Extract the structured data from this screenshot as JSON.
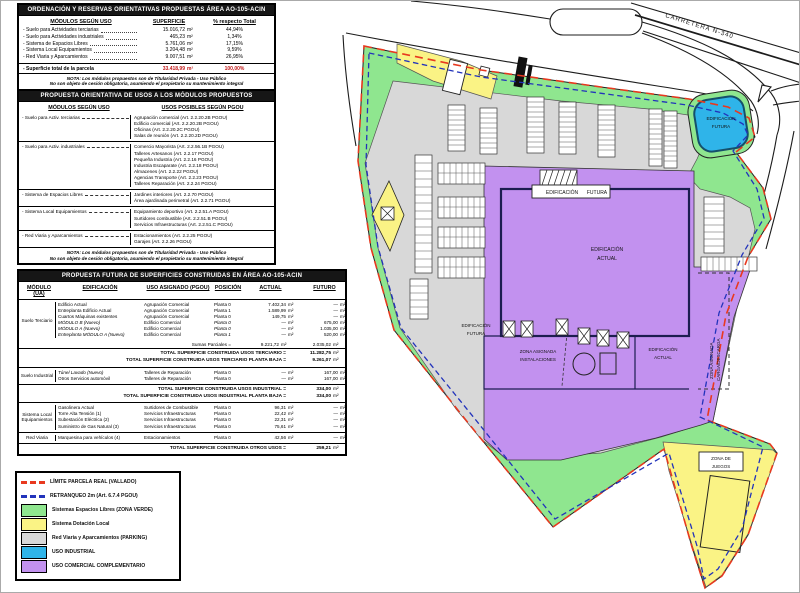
{
  "units": {
    "m2": "m²"
  },
  "table1": {
    "title": "ORDENACIÓN Y RESERVAS ORIENTATIVAS PROPUESTAS ÁREA AO-105-ACIN",
    "col_headers": {
      "modulos": "MÓDULOS SEGÚN USO",
      "superficie": "SUPERFICIE",
      "pct": "% respecto Total"
    },
    "rows": [
      {
        "label": "- Suelo para Actividades terciarias",
        "value": "15.016,72",
        "pct": "44,94%"
      },
      {
        "label": "- Suelo para Actividades industriales",
        "value": "465,23",
        "pct": "1,34%"
      },
      {
        "label": "- Sistema de Espacios Libres",
        "value": "5.761,06",
        "pct": "17,15%"
      },
      {
        "label": "- Sistema Local Equipamientos",
        "value": "3.204,48",
        "pct": "9,59%"
      },
      {
        "label": "- Red Viaria y Aparcamientos",
        "value": "9.007,51",
        "pct": "26,95%"
      }
    ],
    "total": {
      "label": "- Superficie total de la parcela",
      "value": "33.418,99",
      "pct": "100,00%"
    },
    "note1": "NOTA: Los módulos propuestos son de Titularidad Privada - Uso Público",
    "note2": "No son objeto de cesión obligatoria, asumiendo el propietario su mantenimiento integral"
  },
  "table2": {
    "title": "PROPUESTA ORIENTATIVA DE USOS A LOS MÓDULOS PROPUESTOS",
    "col_headers": {
      "modulos": "MÓDULOS SEGÚN USO",
      "usos": "USOS POSIBLES SEGÚN PGOU"
    },
    "rows": [
      {
        "label": "- Suelo para Activ. terciarias",
        "usos": [
          "Agrupación comercial (Art. 2.2.20.2B PGOU)",
          "Edificio comercial (Art. 2.2.20.2B PGOU)",
          "Oficinas (Art. 2.2.20.2C PGOU)",
          "Salas de reunión (Art. 2.2.20.2D PGOU)"
        ]
      },
      {
        "label": "- Suelo para Activ. industriales",
        "usos": [
          "Comercio Mayorista (Art. 2.2.56.1B PGOU)",
          "Talleres Artesanos (Art. 2.2.17 PGOU)",
          "Pequeña Industria (Art. 2.2.16 PGOU)",
          "Industria Escaparate (Art. 2.2.18 PGOU)",
          "Almacenes (Art. 2.2.22 PGOU)",
          "Agencias Transporte (Art. 2.2.23 PGOU)",
          "Talleres Reparación (Art. 2.2.24 PGOU)"
        ]
      },
      {
        "label": "- Sistema de Espacios Libres",
        "usos": [
          "Jardines interiores (Art. 2.2.70 PGOU)",
          "Área ajardinada perimetral (Art. 2.2.71 PGOU)"
        ]
      },
      {
        "label": "- Sistema Local Equipamientos",
        "usos": [
          "Equipamiento deportivo (Art. 2.2.51.A PGOU)",
          "Surtidores combustible (Art. 2.2.51.B PGOU)",
          "Servicios Infraestructuras (Art. 2.2.51.C PGOU)"
        ]
      },
      {
        "label": "- Red Viaria y Aparcamientos",
        "usos": [
          "Estacionamientos (Art. 2.2.25 PGOU)",
          "Garajes (Art. 2.2.26 PGOU)"
        ]
      }
    ],
    "note1": "NOTA: Los módulos propuestos son de Titularidad Privada - Uso Público",
    "note2": "No son objeto de cesión obligatoria, asumiendo el propietario su mantenimiento integral"
  },
  "table3": {
    "title": "PROPUESTA FUTURA DE SUPERFICIES CONSTRUIDAS EN ÁREA AO-105-ACIN",
    "headers": {
      "modulo": "MÓDULO (UA)",
      "edificacion": "EDIFICACIÓN",
      "uso": "USO ASIGNADO (PGOU)",
      "posicion": "POSICIÓN",
      "actual": "ACTUAL",
      "futuro": "FUTURO"
    },
    "terciario": {
      "module": "Suelo Terciario",
      "rows": [
        [
          "Edificio Actual",
          "Agrupación Comercial",
          "Planta 0",
          "7.402,34",
          "—"
        ],
        [
          "Entreplanta Edificio Actual",
          "Agrupación Comercial",
          "Planta 1",
          "1.589,99",
          "—"
        ],
        [
          "Cuartos Máquinas existentes",
          "Agrupación Comercial",
          "Planta 0",
          "149,75",
          "—"
        ],
        [
          "MÓDULO B (Nuevo)",
          "Edificio Comercial",
          "Planta 0",
          "—",
          "675,00"
        ],
        [
          "MÓDULO A (Nuevo)",
          "Edificio Comercial",
          "Planta 0",
          "—",
          "1.035,00"
        ],
        [
          "Entreplanta MÓDULO A (Nuevo)",
          "Edificio Comercial",
          "Planta 1",
          "—",
          "520,00"
        ]
      ],
      "sumas_label": "Sumas Parciales =",
      "sumas_actual": "9.221,72",
      "sumas_futuro": "2.035,02",
      "total1_label": "TOTAL SUPERFICIE CONSTRUIDA USOS TERCIARIO =",
      "total1_value": "11.282,75",
      "total2_label": "TOTAL SUPERFICIE CONSTRUIDA USOS TERCIARIO PLANTA BAJA =",
      "total2_value": "9.261,07"
    },
    "industrial": {
      "module": "Suelo Industrial",
      "rows": [
        [
          "Túnel Lavado (Nuevo)",
          "Talleres de Reparación",
          "Planta 0",
          "—",
          "167,00"
        ],
        [
          "Otros Servicios automóvil",
          "Talleres de Reparación",
          "Planta 0",
          "—",
          "167,00"
        ]
      ],
      "total1_label": "TOTAL SUPERFICIE CONSTRUIDA USOS INDUSTRIAL =",
      "total1_value": "334,00",
      "total2_label": "TOTAL SUPERFICIE CONSTRUIDA USOS INDUSTRIAL PLANTA BAJA =",
      "total2_value": "334,00"
    },
    "otros": {
      "module1": "Sistema Local Equipamientos",
      "rows1": [
        [
          "Gasolinera Actual",
          "Surtidores de Combustible",
          "Planta 0",
          "96,31",
          "—"
        ],
        [
          "Torre Alta Tensión (1)",
          "Servicios Infraestructuras",
          "Planta 0",
          "22,42",
          "—"
        ],
        [
          "Subestación Eléctrica (2)",
          "Servicios Infraestructuras",
          "Planta 0",
          "22,31",
          "—"
        ],
        [
          "Suministro de Gas Natural (3)",
          "Servicios Infraestructuras",
          "Planta 0",
          "75,61",
          "—"
        ]
      ],
      "module2": "Red Viaria",
      "rows2": [
        [
          "Marquesina para vehículos (4)",
          "Estacionamientos",
          "Planta 0",
          "42,56",
          "—"
        ]
      ],
      "total_label": "TOTAL SUPERFICIE CONSTRUIDA OTROS USOS =",
      "total_value": "259,21"
    }
  },
  "legend": {
    "items": [
      {
        "label": "LÍMITE PARCELA REAL (VALLADO)",
        "color": "#E8391F"
      },
      {
        "label": "RETRANQUEO 2m (Art. 6.7.4 PGOU)",
        "color": "#2233BB"
      },
      {
        "label": "Sistemas Espacios Libres (ZONA VERDE)",
        "color": "#8FE68F"
      },
      {
        "label": "Sistema Dotación Local",
        "color": "#FAF385"
      },
      {
        "label": "Red Viaria y Aparcamientos (PARKING)",
        "color": "#D8D8D8"
      },
      {
        "label": "USO INDUSTRIAL",
        "color": "#2FB4E9"
      },
      {
        "label": "USO COMERCIAL COMPLEMENTARIO",
        "color": "#C291EF"
      }
    ]
  },
  "colors": {
    "zona_verde": "#8FE68F",
    "dotacion": "#FAF385",
    "viario": "#D8D8D8",
    "industrial": "#2FB4E9",
    "comercial": "#C291EF",
    "limite": "#E8391F",
    "retranqueo": "#2233BB"
  },
  "map": {
    "carretera": "CARRETERA N-340",
    "edif_futura_l1": "EDIFICACIÓN",
    "edif_futura_l2": "FUTURA",
    "edif_actual_l1": "EDIFICACIÓN",
    "edif_actual_l2": "ACTUAL",
    "zona_instalaciones_l1": "ZONA ASIGNADA",
    "zona_instalaciones_l2": "INSTALACIONES",
    "zona_carga_l1": "ZONA ASIGNADA",
    "zona_carga_l2": "CARGA/DESCARGA",
    "zona_juegos_l1": "ZONA DE",
    "zona_juegos_l2": "JUEGOS"
  }
}
